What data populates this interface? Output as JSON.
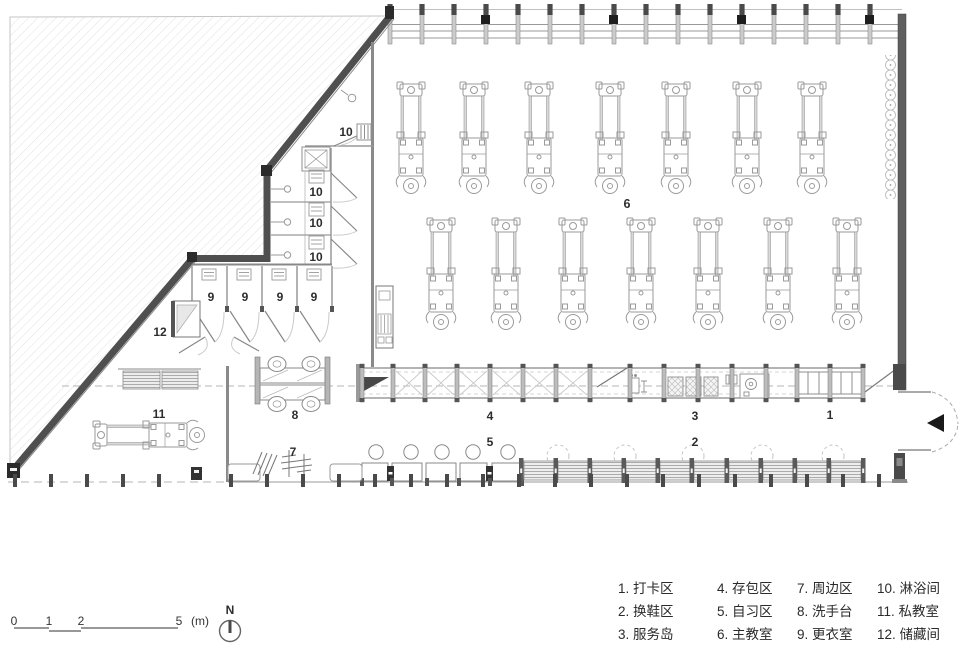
{
  "plan": {
    "room_labels": {
      "r1": "1",
      "r2": "2",
      "r3": "3",
      "r4": "4",
      "r5": "5",
      "r6": "6",
      "r7": "7",
      "r8": "8",
      "r9": "9",
      "r10": "10",
      "r11": "11",
      "r12": "12"
    }
  },
  "legend": {
    "items": [
      "1. 打卡区",
      "2. 换鞋区",
      "3. 服务岛",
      "4. 存包区",
      "5. 自习区",
      "6. 主教室",
      "7. 周边区",
      "8. 洗手台",
      "9. 更衣室",
      "10. 淋浴间",
      "11. 私教室",
      "12. 储藏间"
    ]
  },
  "scale_bar": {
    "ticks": [
      "0",
      "1",
      "2",
      "5"
    ],
    "unit": "(m)"
  },
  "north": {
    "label": "N"
  },
  "colors": {
    "wall_dark": "#4f4f4f",
    "line_gray": "#999999",
    "hatch": "#e0e0e0",
    "text": "#2d2d2d"
  }
}
